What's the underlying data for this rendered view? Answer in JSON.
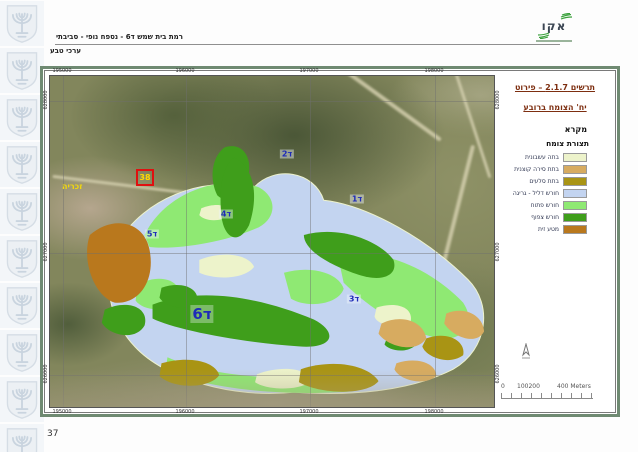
{
  "header": {
    "doc_title": "רמת בית שמש ד6 - נספח נופי - סביבתי",
    "doc_subtitle": "ערכי טבע",
    "logo_text": "אקו",
    "page_number": "37"
  },
  "sidebar": {
    "emblem": "israel-state-emblem",
    "tile_count": 10
  },
  "map": {
    "title_line1": "תרשים 2.1.7 – פירוט",
    "title_line2": "יח' הצומח ברובע",
    "legend_header": "מקרא",
    "legend_group_title": "תצורת צומח",
    "legend_items": [
      {
        "label": "בתה עשבונית",
        "color": "#edf3cb"
      },
      {
        "label": "בתת סירה קוצנית",
        "color": "#d7ab60"
      },
      {
        "label": "בתת סלעים",
        "color": "#a99414"
      },
      {
        "label": "חורש דליל - גריגה",
        "color": "#c3d4f0"
      },
      {
        "label": "חורש פתוח",
        "color": "#8fe973"
      },
      {
        "label": "חורש צפוף",
        "color": "#3f9e1b"
      },
      {
        "label": "מטע זית",
        "color": "#b9781d"
      }
    ],
    "unit_labels": [
      {
        "text": "ד2",
        "x": 238,
        "y": 79
      },
      {
        "text": "ד1",
        "x": 308,
        "y": 124
      },
      {
        "text": "ד4",
        "x": 177,
        "y": 139
      },
      {
        "text": "ד5",
        "x": 103,
        "y": 159
      },
      {
        "text": "ד3",
        "x": 305,
        "y": 224
      },
      {
        "text": "ד6",
        "x": 153,
        "y": 239,
        "big": true
      }
    ],
    "site_box_label": "38",
    "place_label": "זכריה",
    "grid_labels": {
      "top": [
        "195000",
        "196000",
        "197000",
        "198000"
      ],
      "bottom": [
        "195000",
        "196000",
        "197000",
        "198000"
      ],
      "left": [
        "628000",
        "627000",
        "626000"
      ],
      "right": [
        "628000",
        "627000",
        "626000"
      ]
    },
    "scale_bar": {
      "labels": [
        "0",
        "100200",
        "400 Meters"
      ]
    }
  }
}
